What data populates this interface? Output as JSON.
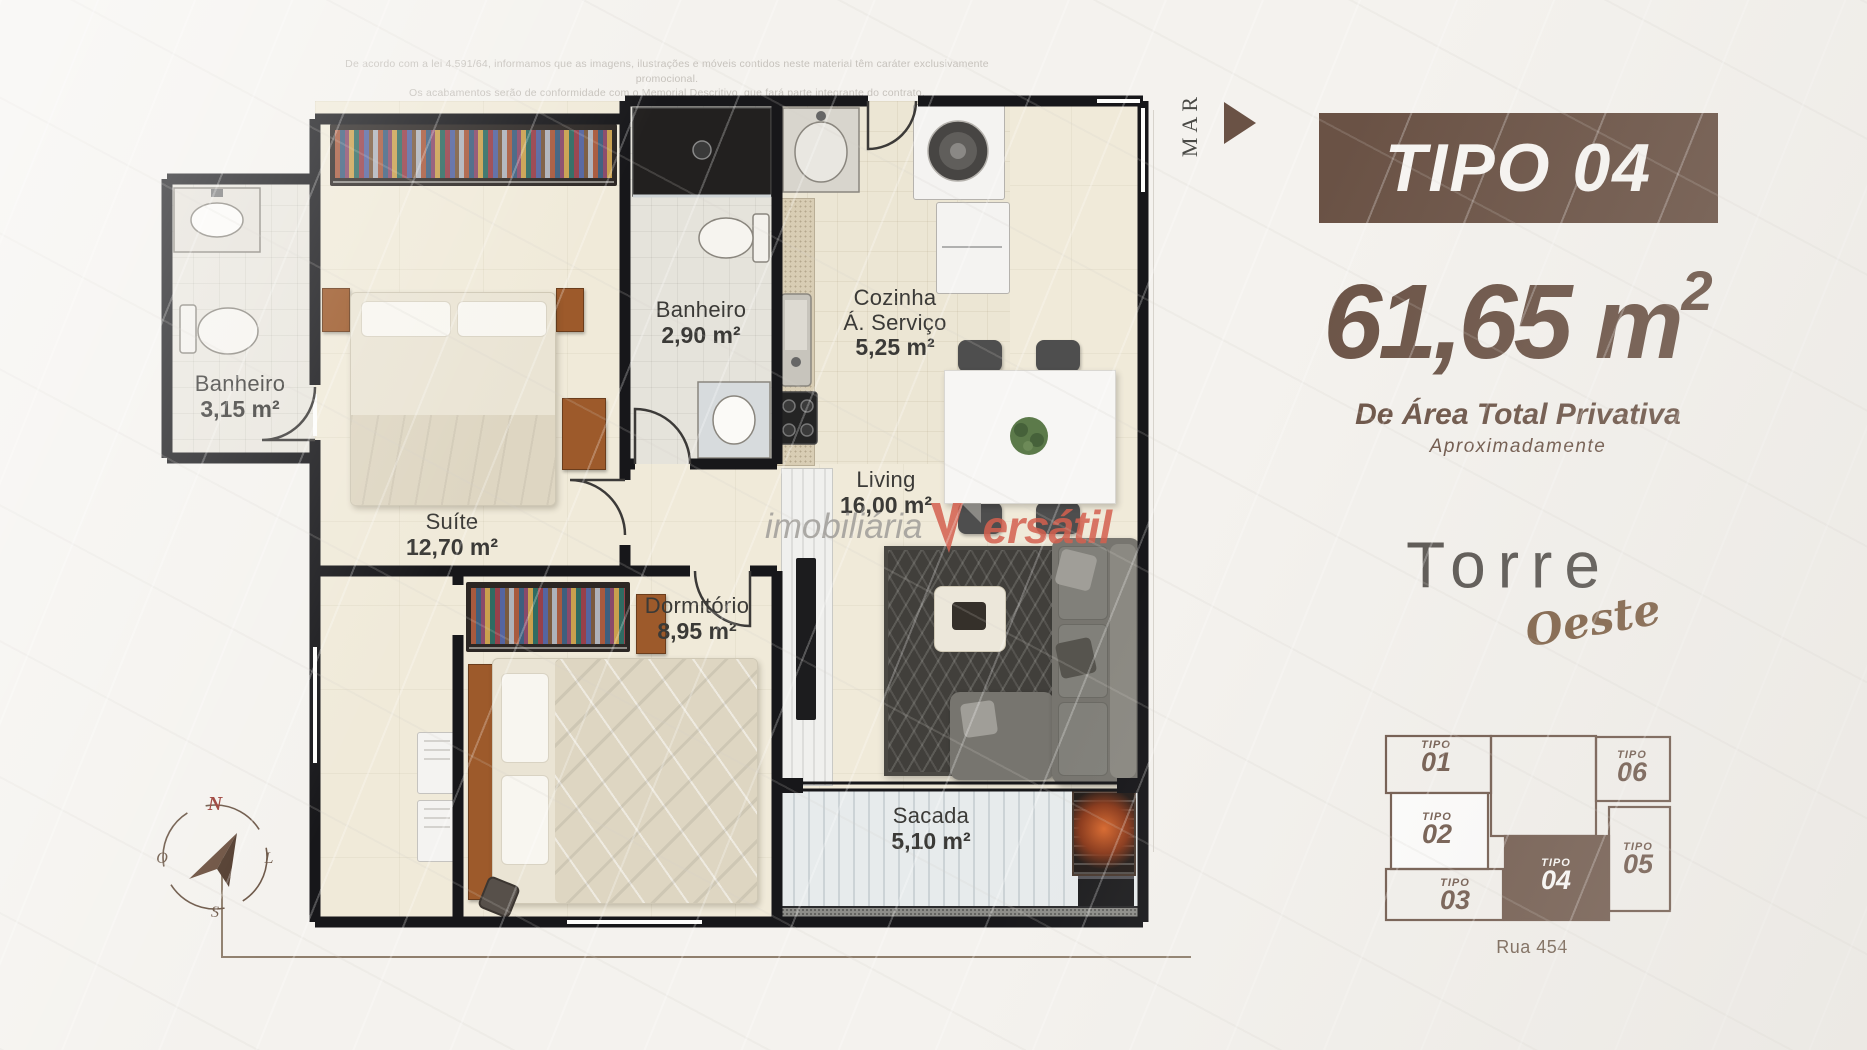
{
  "disclaimer": {
    "line1": "De acordo com a lei 4.591/64, informamos que as imagens, ilustrações e móveis contidos neste material têm caráter exclusivamente promocional.",
    "line2": "Os acabamentos serão de conformidade com o Memorial Descritivo, que fará parte integrante do contrato."
  },
  "floor_plan": {
    "mar_label": "MAR",
    "rooms": {
      "banheiro_suite": {
        "name": "Banheiro",
        "area": "3,15 m²"
      },
      "suite": {
        "name": "Suíte",
        "area": "12,70 m²"
      },
      "banheiro_social": {
        "name": "Banheiro",
        "area": "2,90 m²"
      },
      "cozinha": {
        "line1": "Cozinha",
        "line2": "Á. Serviço",
        "area": "5,25 m²"
      },
      "living": {
        "name": "Living",
        "area": "16,00 m²"
      },
      "dormitorio": {
        "name": "Dormitório",
        "area": "8,95 m²"
      },
      "sacada": {
        "name": "Sacada",
        "area": "5,10 m²"
      }
    },
    "compass": {
      "north": "N",
      "south": "S",
      "east": "L",
      "west": "O"
    }
  },
  "watermark": {
    "prefix": "imobiliária",
    "brand_initial": "V",
    "brand_rest": "ersátil",
    "brand_full": "Versátil"
  },
  "info_panel": {
    "type_label": "TIPO 04",
    "area_value": "61,65",
    "area_unit_base": "m",
    "area_unit_exp": "2",
    "area_line1": "De Área Total Privativa",
    "area_line2": "Aproximadamente",
    "tower": {
      "name": "Torre",
      "wing": "Oeste"
    },
    "keyplan": {
      "street": "Rua 454",
      "units": {
        "u01": {
          "prefix": "TIPO",
          "number": "01"
        },
        "u02": {
          "prefix": "TIPO",
          "number": "02"
        },
        "u03": {
          "prefix": "TIPO",
          "number": "03"
        },
        "u04": {
          "prefix": "TIPO",
          "number": "04"
        },
        "u05": {
          "prefix": "TIPO",
          "number": "05"
        },
        "u06": {
          "prefix": "TIPO",
          "number": "06"
        }
      }
    }
  },
  "colors": {
    "brand_brown": "#6a5245",
    "compass_north_red": "#9a3c35",
    "watermark_red": "#d4604f",
    "wall_black": "#17171a"
  }
}
